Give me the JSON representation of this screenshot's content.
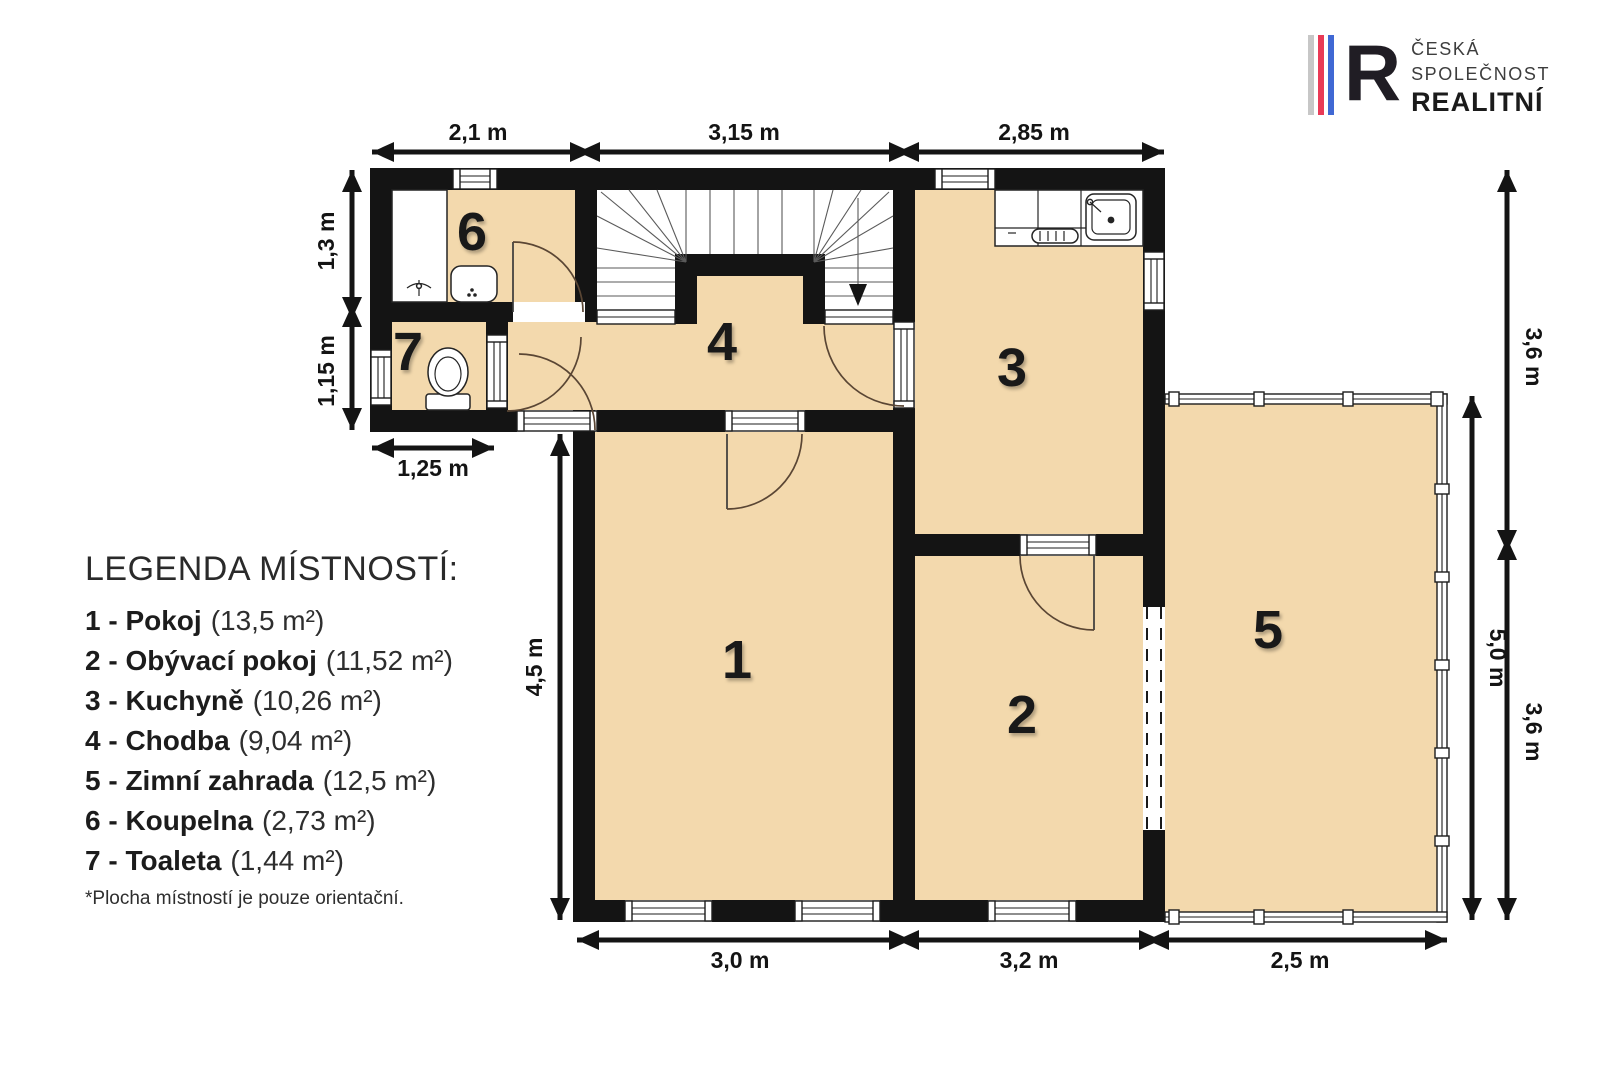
{
  "logo": {
    "letter": "R",
    "line1": "ČESKÁ",
    "line2": "SPOLEČNOST",
    "line3": "REALITNÍ"
  },
  "legend": {
    "title": "LEGENDA MÍSTNOSTÍ:",
    "items": [
      {
        "label": "1 - Pokoj",
        "area": "(13,5 m²)"
      },
      {
        "label": "2 - Obývací pokoj",
        "area": "(11,52 m²)"
      },
      {
        "label": "3 - Kuchyně",
        "area": "(10,26 m²)"
      },
      {
        "label": "4 - Chodba",
        "area": "(9,04 m²)"
      },
      {
        "label": "5 - Zimní zahrada",
        "area": "(12,5 m²)"
      },
      {
        "label": "6 - Koupelna",
        "area": "(2,73 m²)"
      },
      {
        "label": "7 - Toaleta",
        "area": "(1,44 m²)"
      }
    ],
    "footnote": "*Plocha místností je pouze orientační."
  },
  "rooms": [
    {
      "number": "1"
    },
    {
      "number": "2"
    },
    {
      "number": "3"
    },
    {
      "number": "4"
    },
    {
      "number": "5"
    },
    {
      "number": "6"
    },
    {
      "number": "7"
    }
  ],
  "dimensions": {
    "top": [
      "2,1 m",
      "3,15 m",
      "2,85 m"
    ],
    "bottom": [
      "3,0 m",
      "3,2 m",
      "2,5 m"
    ],
    "left": [
      "1,3 m",
      "1,15 m",
      "1,25 m",
      "4,5 m"
    ],
    "right": [
      "3,6 m",
      "5,0 m",
      "3,6 m"
    ]
  },
  "colors": {
    "room_fill": "#F3D9AD",
    "wall": "#141414",
    "logo_gray": "#C7C7C7",
    "logo_red": "#E93A56",
    "logo_blue": "#4068D4"
  }
}
